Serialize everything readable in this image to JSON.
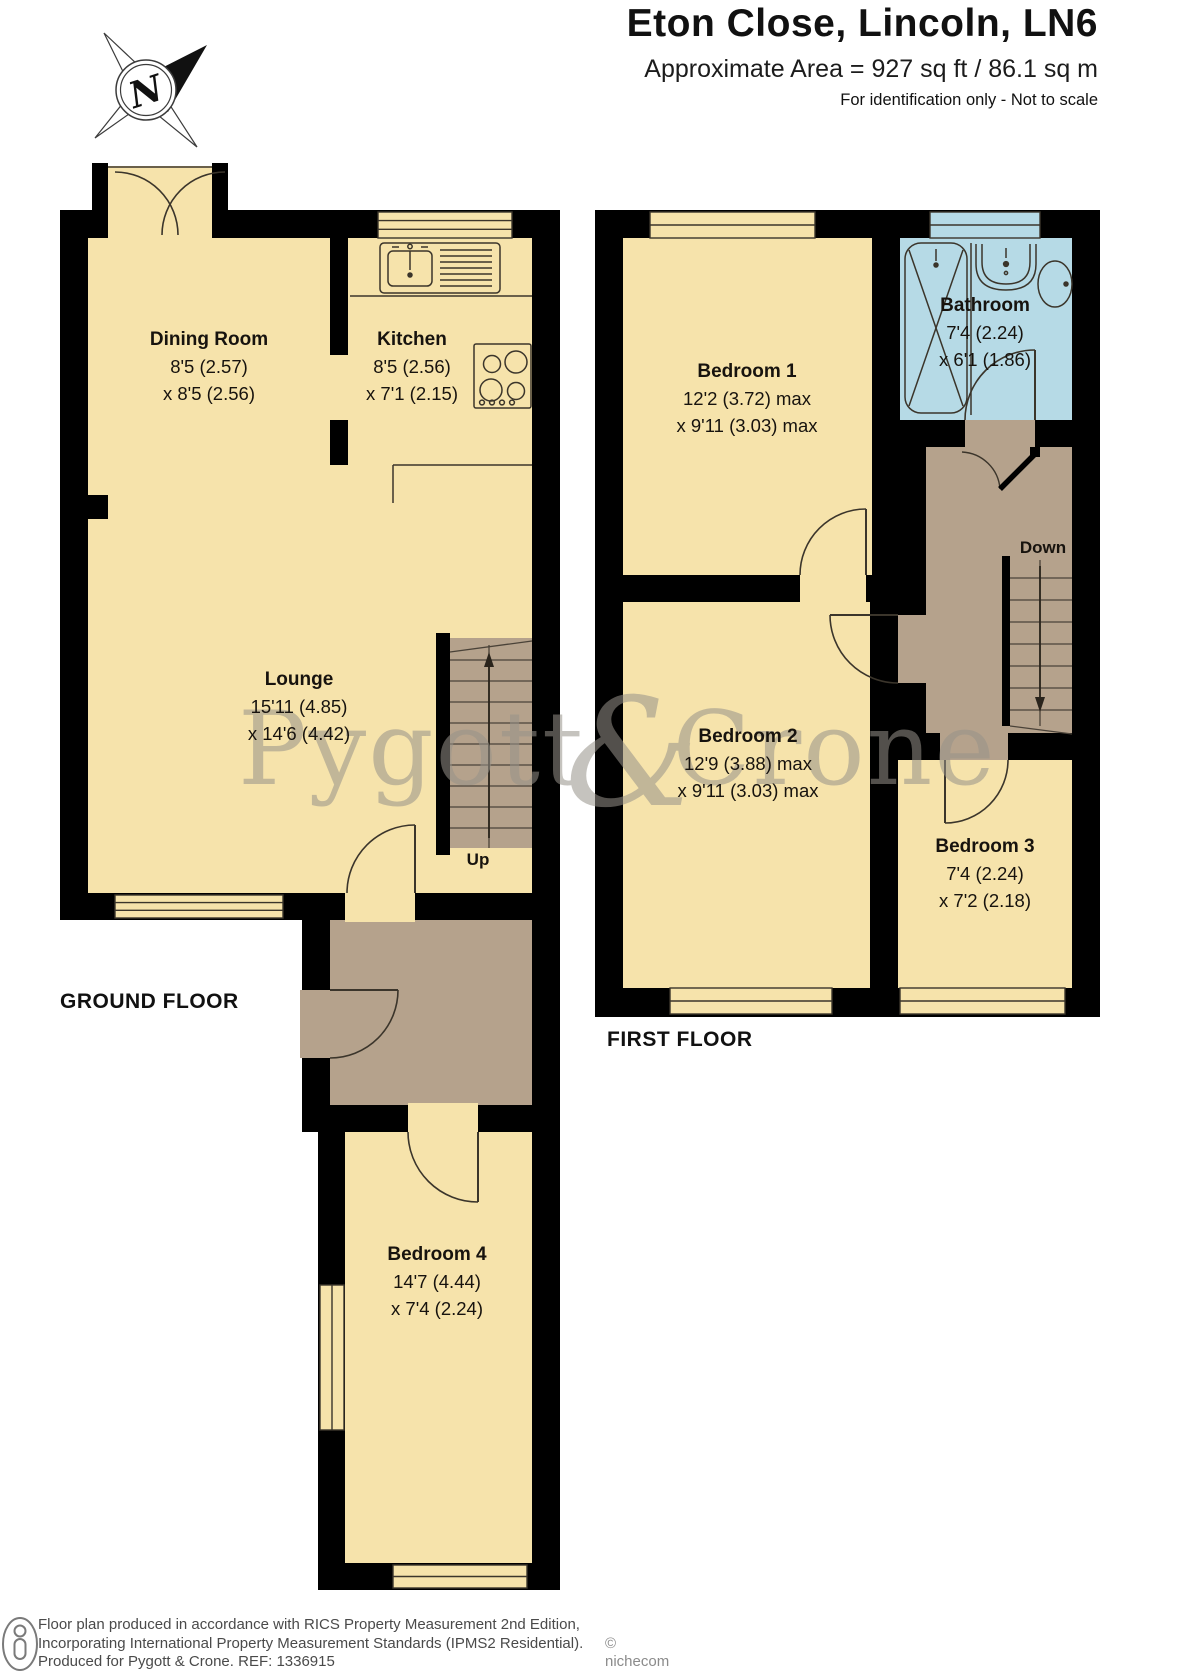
{
  "header": {
    "title": "Eton Close, Lincoln, LN6",
    "subtitle": "Approximate Area = 927 sq ft / 86.1 sq m",
    "note": "For identification only - Not to scale"
  },
  "compass": {
    "label": "N"
  },
  "floors": {
    "ground": {
      "label": "GROUND FLOOR"
    },
    "first": {
      "label": "FIRST FLOOR"
    }
  },
  "rooms": {
    "dining": {
      "name": "Dining Room",
      "dim1": "8'5 (2.57)",
      "dim2": "x 8'5 (2.56)"
    },
    "kitchen": {
      "name": "Kitchen",
      "dim1": "8'5 (2.56)",
      "dim2": "x 7'1 (2.15)"
    },
    "lounge": {
      "name": "Lounge",
      "dim1": "15'11 (4.85)",
      "dim2": "x 14'6 (4.42)"
    },
    "bedroom4": {
      "name": "Bedroom 4",
      "dim1": "14'7 (4.44)",
      "dim2": "x 7'4 (2.24)"
    },
    "bedroom1": {
      "name": "Bedroom 1",
      "dim1": "12'2 (3.72) max",
      "dim2": "x 9'11 (3.03) max"
    },
    "bathroom": {
      "name": "Bathroom",
      "dim1": "7'4 (2.24)",
      "dim2": "x 6'1 (1.86)"
    },
    "bedroom2": {
      "name": "Bedroom 2",
      "dim1": "12'9 (3.88) max",
      "dim2": "x 9'11 (3.03) max"
    },
    "bedroom3": {
      "name": "Bedroom 3",
      "dim1": "7'4 (2.24)",
      "dim2": "x 7'2 (2.18)"
    }
  },
  "stairs": {
    "up_label": "Up",
    "down_label": "Down"
  },
  "watermark": {
    "word1": "Pygott",
    "amp": "&",
    "word2": "Crone"
  },
  "footer": {
    "line1": "Floor plan produced in accordance with RICS Property Measurement 2nd Edition,",
    "line2": "Incorporating International Property Measurement Standards (IPMS2 Residential).",
    "line3": "Produced for Pygott & Crone.   REF:  1336915",
    "copyright": "© nichecom 2025."
  },
  "colors": {
    "room_cream": "#f6e3ab",
    "hall_brown": "#b5a28c",
    "bathroom_blue": "#b6dae6",
    "wall_black": "#000000",
    "watermark_gray": "#97938a"
  }
}
